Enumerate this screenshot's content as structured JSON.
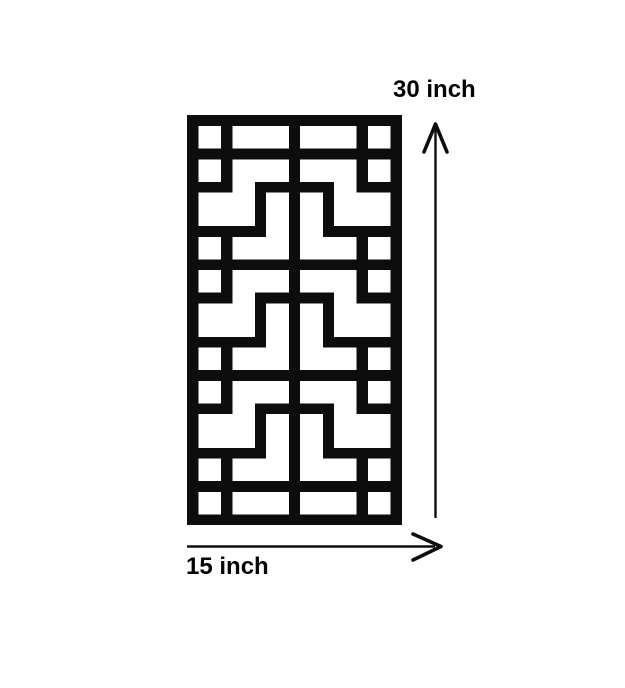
{
  "page": {
    "background": "#ffffff",
    "ink": "#0d0d0d"
  },
  "diagram": {
    "type": "dimension-diagram",
    "subject": "rectangular decorative fretwork lattice panel",
    "panel": {
      "fill": "#0d0d0d",
      "opening_fill": "#ffffff",
      "width_px": 215,
      "height_px": 410,
      "grid": {
        "cols": 19,
        "rows": 37
      },
      "row_types": [
        "B",
        "sqw",
        "sqw",
        "SX",
        "sqw",
        "sqw",
        "legU",
        "mid",
        "mid",
        "mid",
        "legL",
        "sqw",
        "sqw",
        "SX",
        "sqw",
        "sqw",
        "legU",
        "mid",
        "mid",
        "mid",
        "legL",
        "sqw",
        "sqw",
        "SX",
        "sqw",
        "sqw",
        "legU",
        "mid",
        "mid",
        "mid",
        "legL",
        "sqw",
        "sqw",
        "SX",
        "sqw",
        "sqw",
        "B"
      ],
      "openings_by_type": {
        "B": [],
        "SX": [],
        "sqw": [
          [
            1,
            2
          ],
          [
            4,
            8
          ],
          [
            10,
            14
          ],
          [
            16,
            17
          ]
        ],
        "legU": [
          [
            4,
            5
          ],
          [
            13,
            14
          ]
        ],
        "mid": [
          [
            1,
            5
          ],
          [
            7,
            8
          ],
          [
            10,
            11
          ],
          [
            13,
            17
          ]
        ],
        "legL": [
          [
            7,
            8
          ],
          [
            10,
            11
          ]
        ]
      }
    },
    "dimensions": {
      "height": {
        "label": "30 inch",
        "axis": "vertical",
        "arrow_direction": "up"
      },
      "width": {
        "label": "15 inch",
        "axis": "horizontal",
        "arrow_direction": "right"
      }
    }
  }
}
